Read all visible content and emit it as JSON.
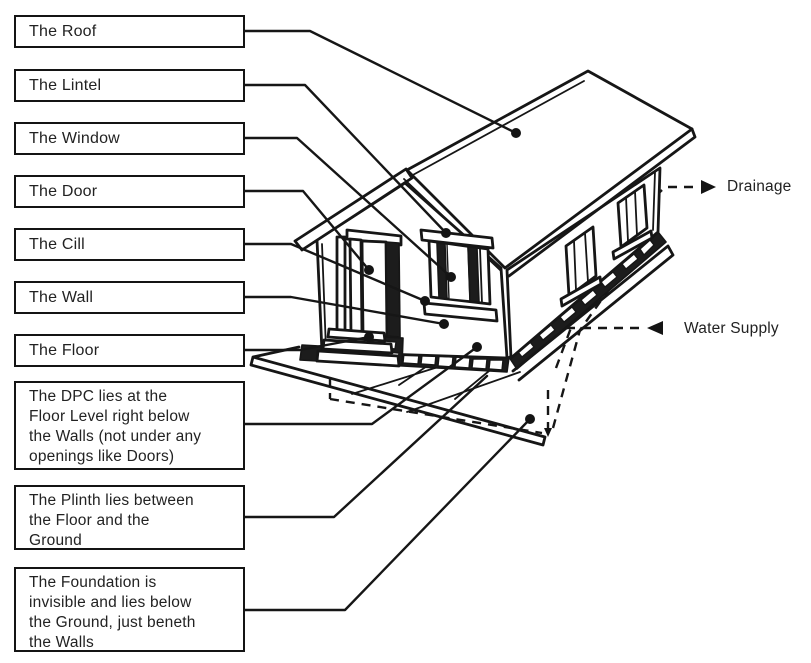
{
  "figure": {
    "title": "House construction parts diagram",
    "background_color": "#ffffff",
    "ink_color": "#161616"
  },
  "labels": [
    {
      "id": "roof",
      "text": "The Roof"
    },
    {
      "id": "lintel",
      "text": "The Lintel"
    },
    {
      "id": "window",
      "text": "The Window"
    },
    {
      "id": "door",
      "text": "The Door"
    },
    {
      "id": "cill",
      "text": "The Cill"
    },
    {
      "id": "wall",
      "text": "The Wall"
    },
    {
      "id": "floor",
      "text": "The Floor"
    },
    {
      "id": "dpc",
      "text": "The DPC lies at the\nFloor Level right below\nthe Walls (not under any\nopenings like Doors)"
    },
    {
      "id": "plinth",
      "text": "The Plinth lies between\nthe Floor and the\nGround"
    },
    {
      "id": "foundation",
      "text": "The Foundation is\ninvisible and lies below\nthe Ground, just beneth\nthe Walls"
    }
  ],
  "annotations": {
    "drainage": "Drainage",
    "water_supply": "Water Supply"
  },
  "icons": {
    "drainage_arrow": "right-arrow-icon",
    "water_supply_arrow": "left-arrow-icon",
    "foundation_corner_arrow": "down-arrow-icon"
  }
}
